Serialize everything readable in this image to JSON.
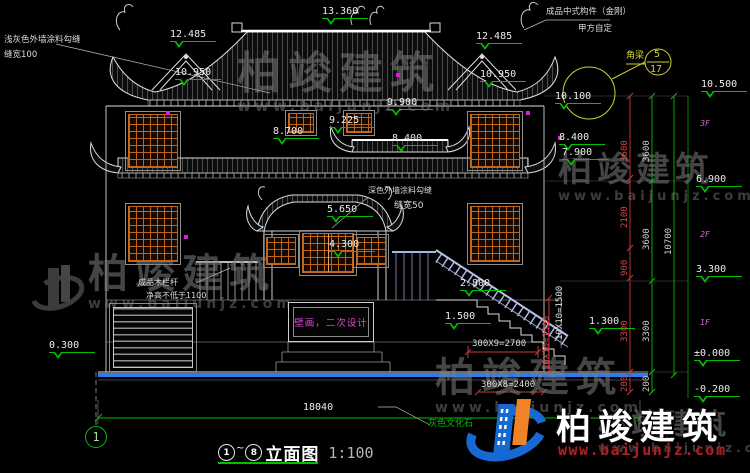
{
  "wm": {
    "brand": "柏竣建筑",
    "url": "www.baijunjz.com"
  },
  "logo": {
    "brand": "柏竣建筑",
    "url": "www.baijunjz.com"
  },
  "title": {
    "c1": "1",
    "tilde": "~",
    "c8": "8",
    "name": "立面图",
    "scale": "1:100"
  },
  "axis": {
    "b1": "1"
  },
  "notes": {
    "wall_light_1": "浅灰色外墙涂料勾缝",
    "wall_light_2": "缝宽100",
    "wall_dark_1": "深色外墙涂料勾缝",
    "wall_dark_2": "缝宽50",
    "component_1": "成品中式构件（金刚）",
    "component_2": "甲方自定",
    "railing_1": "成品木栏杆",
    "railing_2": "净高不低于1100",
    "mural": "壁画，二次设计",
    "stone": "灰色文化石",
    "detail_label": "角梁",
    "detail_num": "5",
    "detail_den": "17"
  },
  "levels": {
    "l13360": "13.360",
    "l12485": "12.485",
    "l10950": "10.950",
    "l10500": "10.500",
    "l10100": "10.100",
    "l9900": "9.900",
    "l9225": "9.225",
    "l8700": "8.700",
    "l8400": "8.400",
    "l7900": "7.900",
    "l6900": "6.900",
    "l5650": "5.650",
    "l4300": "4.300",
    "l3300": "3.300",
    "l2800": "2.800",
    "l1500": "1.500",
    "l1300": "1.300",
    "l0300": "0.300",
    "l0": "±0.000",
    "lm200": "-0.200"
  },
  "dims": {
    "total": "18040",
    "right_total": "10700",
    "red": [
      "3600",
      "2100",
      "900",
      "3300",
      "200"
    ],
    "green": [
      "3600",
      "3600",
      "3300",
      "200"
    ],
    "stair_upper": "300X9=2700",
    "stair_lower": "300X8=2400",
    "rise_a": "10X10=1500",
    "rise_b": "10X10=1500"
  },
  "floors": {
    "f3": "3F",
    "f2": "2F",
    "f1": "1F"
  }
}
